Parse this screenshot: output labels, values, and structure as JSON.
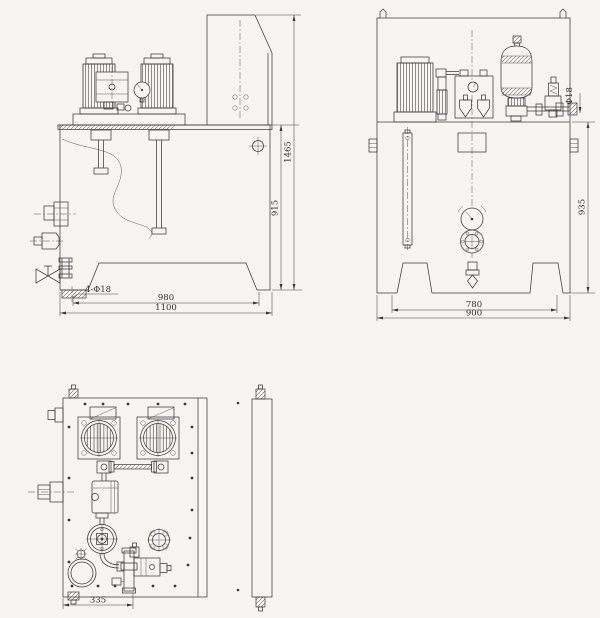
{
  "sheet": {
    "background": "#f6f5f2",
    "line_color": "#3b3b3b"
  },
  "front_view": {
    "dim_overall_height": "1465",
    "dim_tank_height": "915",
    "dim_foot_hole_span": "980",
    "dim_overall_width": "1100",
    "foot_hole_callout": "4-Φ18"
  },
  "side_view": {
    "dim_tank_height": "935",
    "dim_foot_span": "780",
    "dim_overall_width": "900",
    "outlet_pipe_callout": "Φ18"
  },
  "top_view": {
    "dim_drain_valve_offset": "335"
  }
}
